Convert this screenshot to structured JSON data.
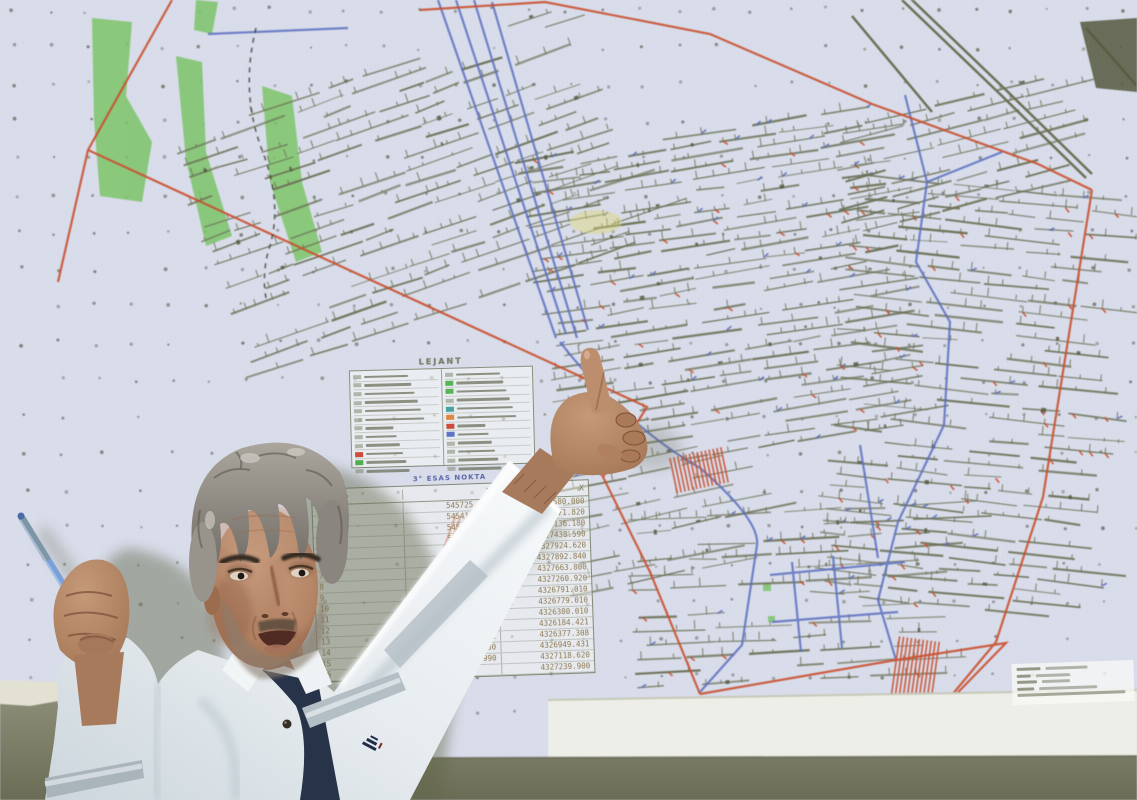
{
  "screen": {
    "legend": {
      "title": "LEJANT",
      "left_chips": [
        null,
        null,
        null,
        null,
        null,
        null,
        null,
        null,
        null,
        "#cf4a38",
        "#4fae4f",
        null
      ],
      "right_chips": [
        null,
        "#57b557",
        "#57b557",
        null,
        "#46a3a0",
        "#e0873f",
        "#cf4a38",
        "#5b74c8",
        null,
        null,
        null,
        null
      ]
    },
    "coord_table": {
      "title": "3° ESAS NOKTA",
      "headers": [
        "NoktaNo",
        "Y",
        "X"
      ],
      "rows": [
        [
          "1",
          "545725.000",
          "4327580.000"
        ],
        [
          "2",
          "545415.660",
          "4327171.820"
        ],
        [
          "3",
          "545865.748",
          "4327136.180"
        ],
        [
          "4",
          "545969.600",
          "4327438.590"
        ],
        [
          "5",
          "546522.718",
          "4327924.620"
        ],
        [
          "6",
          "546548.120",
          "4327892.840"
        ],
        [
          "7",
          "546211.140",
          "4327663.800"
        ],
        [
          "8",
          "546363.741",
          "4327260.920"
        ],
        [
          "9",
          "546377.090",
          "4326791.010"
        ],
        [
          "10",
          "545873.900",
          "4326779.010"
        ],
        [
          "11",
          "545737.040",
          "4326380.010"
        ],
        [
          "12",
          "546043.208",
          "4326184.421"
        ],
        [
          "13",
          "546371.581",
          "4326377.308"
        ],
        [
          "14",
          "546179.030",
          "4326949.431"
        ],
        [
          "15",
          "546266.990",
          "4327118.620"
        ],
        [
          "16",
          "",
          "4327239.900"
        ]
      ]
    },
    "colors": {
      "gallery_line": "#6b7055",
      "boundary_line": "#c9502f",
      "haulage_line": "#5b6fc0",
      "surface_green": "#7cc469",
      "screen_background": "#d8dcea",
      "wall": "#85866e"
    }
  }
}
